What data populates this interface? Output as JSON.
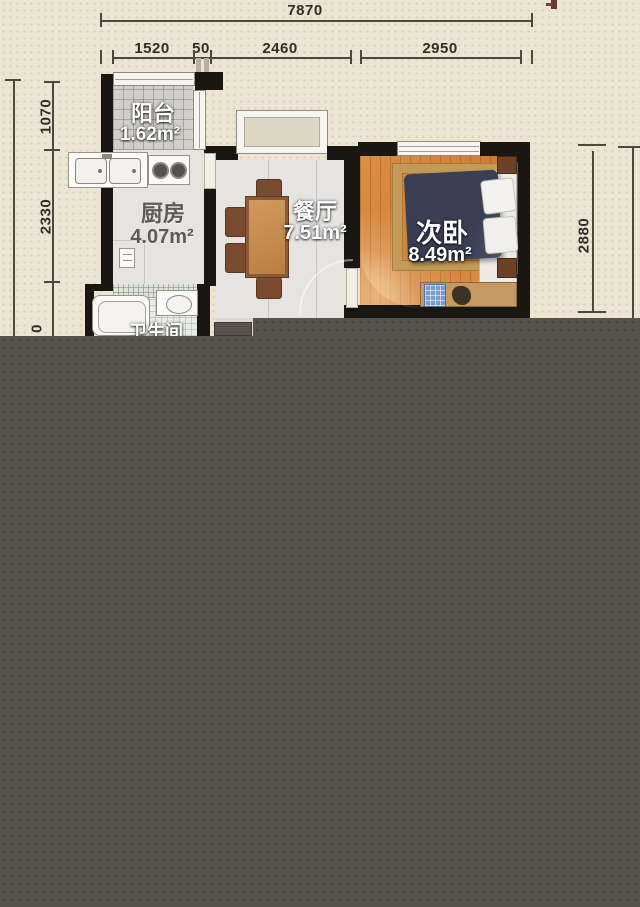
{
  "dimensions": {
    "top_total": "7870",
    "top_segments": [
      "1520",
      "50",
      "2460",
      "2950"
    ],
    "left_segments": [
      "1070",
      "2330",
      "0"
    ],
    "right_segments": [
      "2880"
    ]
  },
  "rooms": {
    "balcony": {
      "label": "阳台",
      "area": "1.62m²"
    },
    "kitchen": {
      "label": "厨房",
      "area": "4.07m²"
    },
    "dining": {
      "label": "餐厅",
      "area": "7.51m²"
    },
    "bedroom": {
      "label": "次卧",
      "area": "8.49m²"
    },
    "bathroom": {
      "label": "卫生间"
    }
  },
  "colors": {
    "paper": "#ede5d3",
    "overlay": "#56534b",
    "wall": "#1a1713",
    "wood_floor": "#d8893f",
    "dim_text": "#332c24",
    "label_text": "#ffffff"
  }
}
